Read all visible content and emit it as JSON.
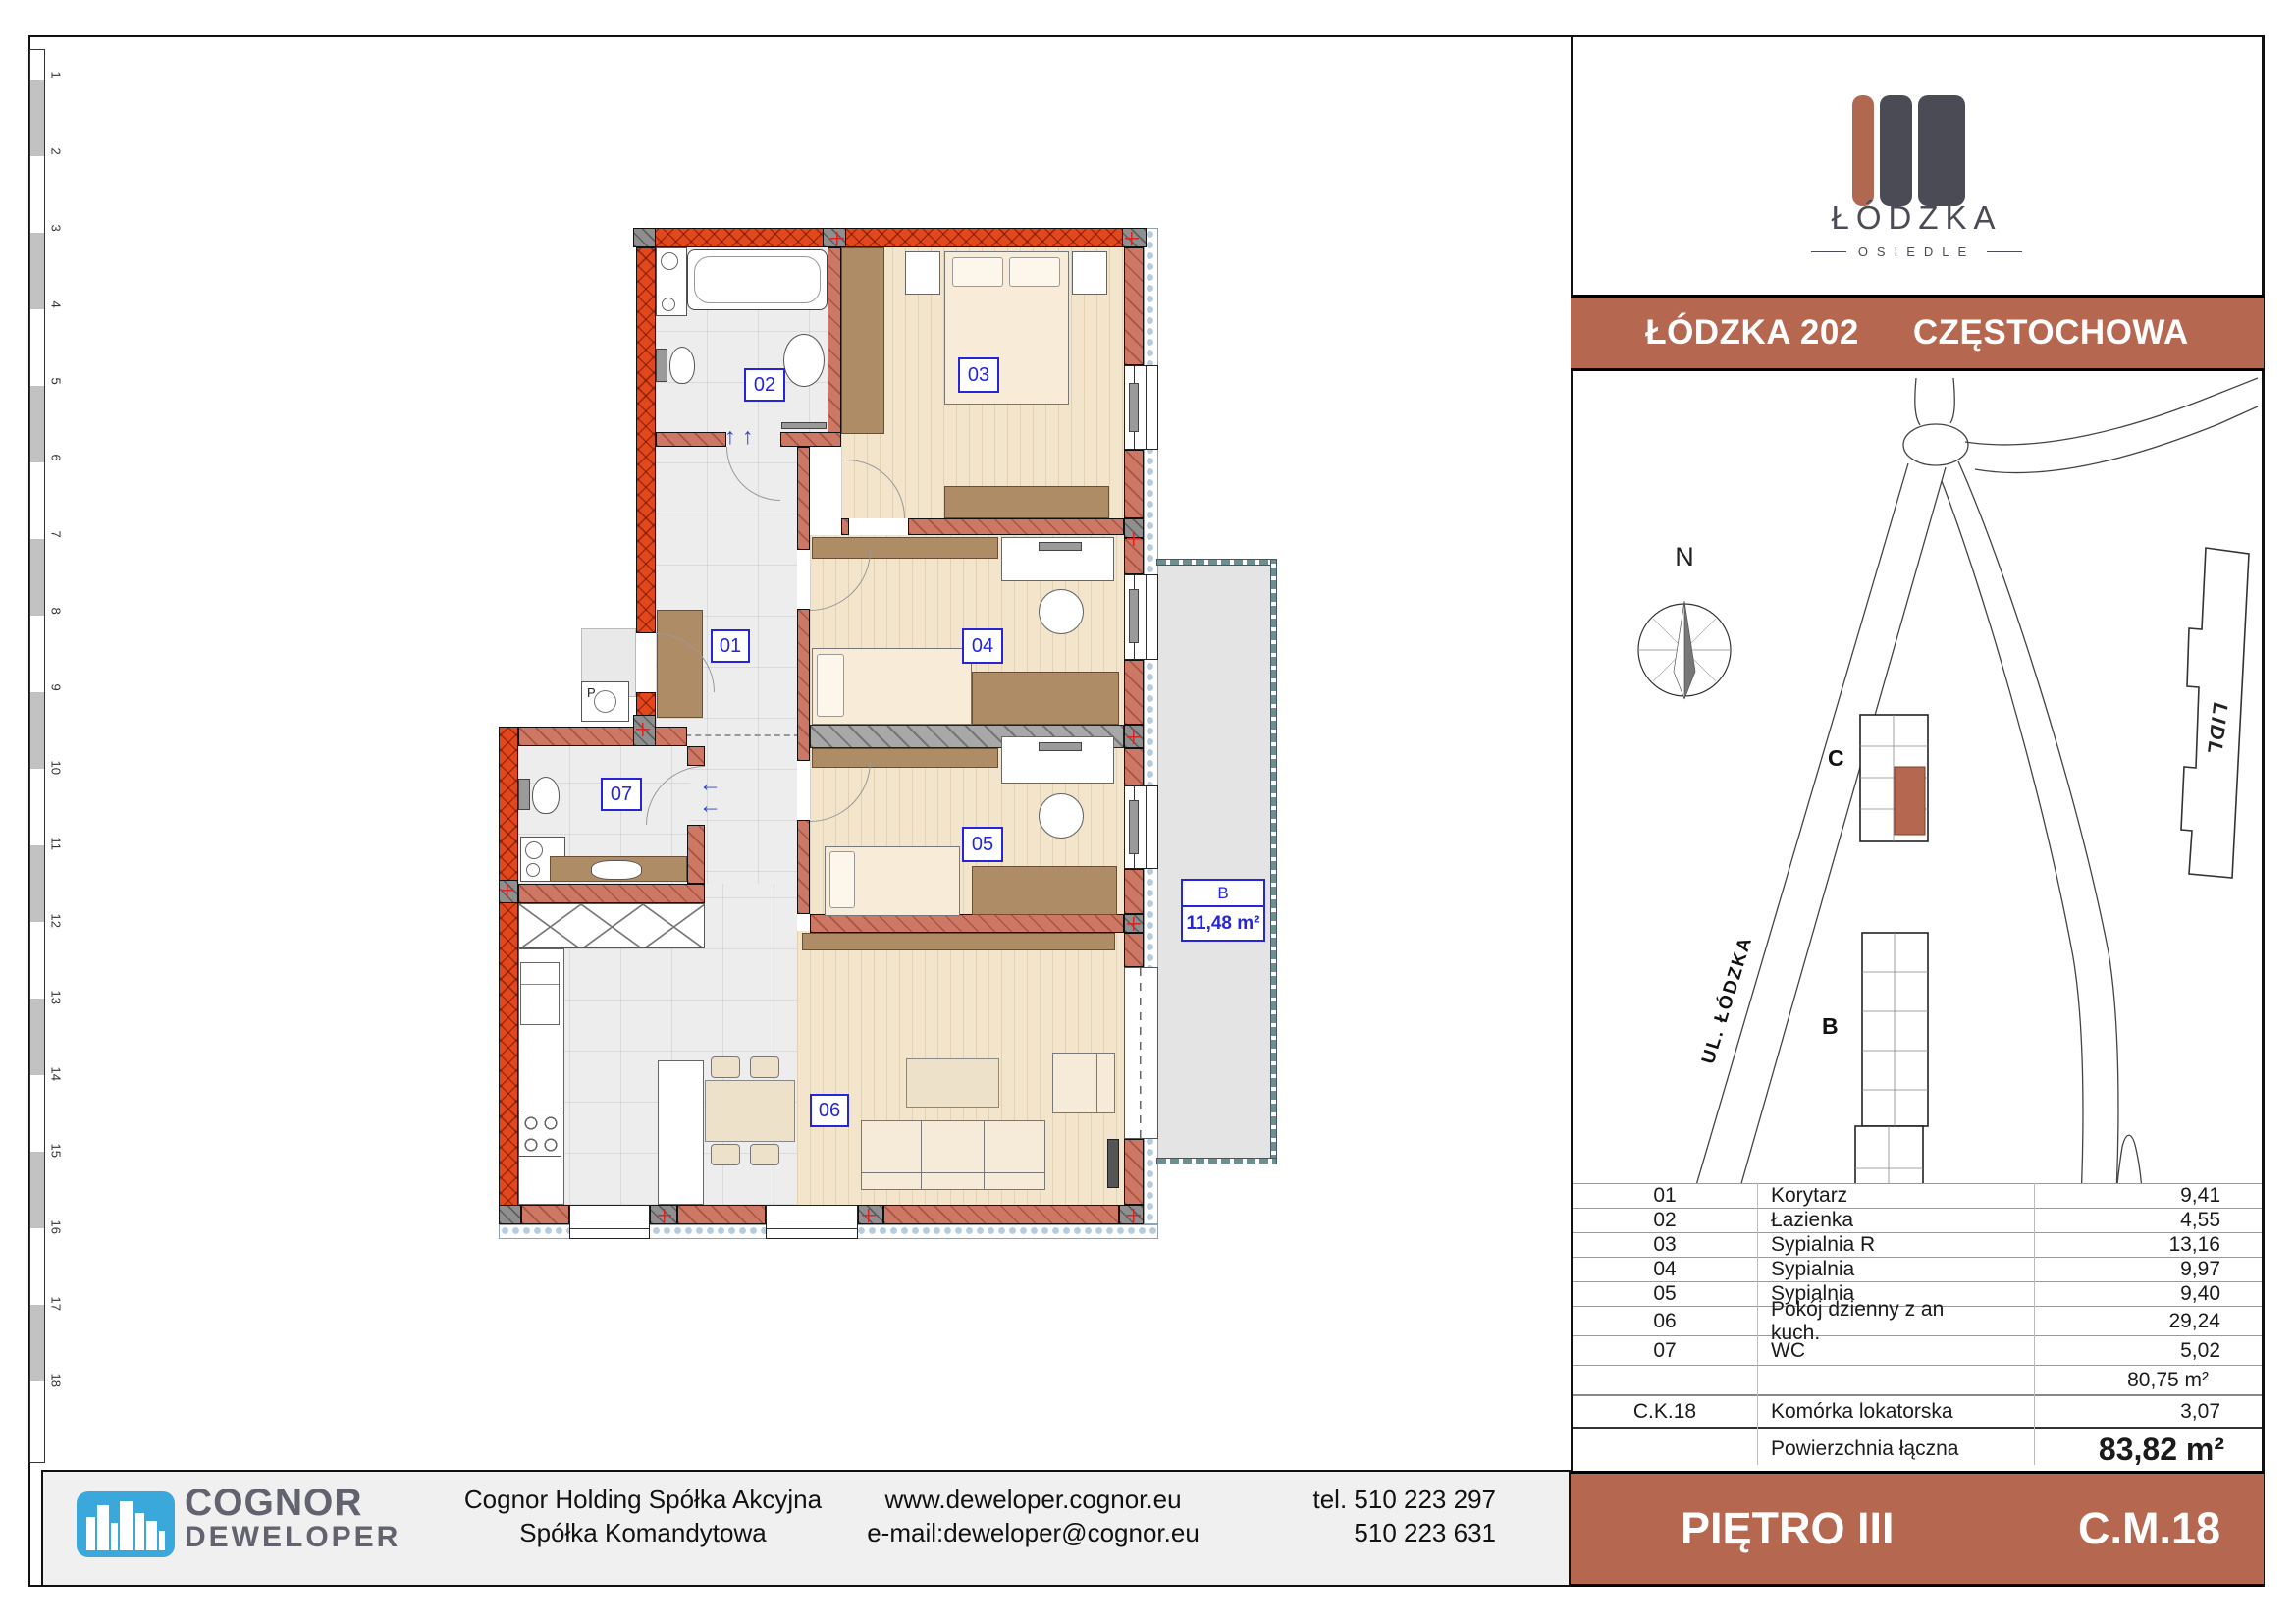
{
  "ruler": {
    "numbers": [
      "1",
      "2",
      "3",
      "4",
      "5",
      "6",
      "7",
      "8",
      "9",
      "10",
      "11",
      "12",
      "13",
      "14",
      "15",
      "16",
      "17",
      "18"
    ]
  },
  "plan": {
    "labels": [
      {
        "text": "01"
      },
      {
        "text": "02"
      },
      {
        "text": "03"
      },
      {
        "text": "04"
      },
      {
        "text": "05"
      },
      {
        "text": "06"
      },
      {
        "text": "07"
      }
    ],
    "balcony": {
      "code": "B",
      "area": "11,48 m²"
    },
    "washer_label": "P",
    "arrows_up": "↑ ↑",
    "arrow_left": "←"
  },
  "brand": {
    "title": "ŁÓDZKA",
    "subtitle": "OSIEDLE"
  },
  "header": {
    "left": "ŁÓDZKA 202",
    "right": "CZĘSTOCHOWA"
  },
  "map": {
    "north": "N",
    "street_lodzka": "UL. ŁÓDZKA",
    "street_obroncow_line1": "UL. OBROŃCÓW",
    "street_obroncow_line2": "WESTERPLATTE",
    "lidl": "LIDL",
    "building_a": "A",
    "building_b": "B",
    "building_c": "C"
  },
  "table": {
    "rows": [
      {
        "no": "01",
        "name": "Korytarz",
        "value": "9,41",
        "type": "room"
      },
      {
        "no": "02",
        "name": "Łazienka",
        "value": "4,55",
        "type": "room"
      },
      {
        "no": "03",
        "name": "Sypialnia R",
        "value": "13,16",
        "type": "room"
      },
      {
        "no": "04",
        "name": "Sypialnia",
        "value": "9,97",
        "type": "room"
      },
      {
        "no": "05",
        "name": "Sypialnia",
        "value": "9,40",
        "type": "room"
      },
      {
        "no": "06",
        "name": "Pokój dzienny z an kuch.",
        "value": "29,24",
        "type": "roomtall"
      },
      {
        "no": "07",
        "name": "WC",
        "value": "5,02",
        "type": "roomtall"
      },
      {
        "no": "",
        "name": "",
        "value": "80,75 m²",
        "type": "subtotal"
      },
      {
        "no": "C.K.18",
        "name": "Komórka lokatorska",
        "value": "3,07",
        "type": "storage"
      },
      {
        "no": "",
        "name": "Powierzchnia łączna",
        "value": "83,82 m²",
        "type": "total"
      }
    ]
  },
  "floor_bar": {
    "floor": "PIĘTRO III",
    "unit": "C.M.18"
  },
  "footer": {
    "brand_line1": "COGNOR",
    "brand_line2": "DEWELOPER",
    "company_line1": "Cognor Holding Spółka Akcyjna",
    "company_line2": "Spółka Komandytowa",
    "website": "www.deweloper.cognor.eu",
    "email": "e-mail:deweloper@cognor.eu",
    "phone1": "tel. 510 223 297",
    "phone2": "510 223 631"
  },
  "colors": {
    "accent": "#b5674f",
    "logo_dark": "#4b4b56",
    "cognor_blue": "#3ba8db",
    "label_blue": "#2626d8",
    "exterior_wall": "#e2481b",
    "interior_wall": "#cd7765"
  }
}
